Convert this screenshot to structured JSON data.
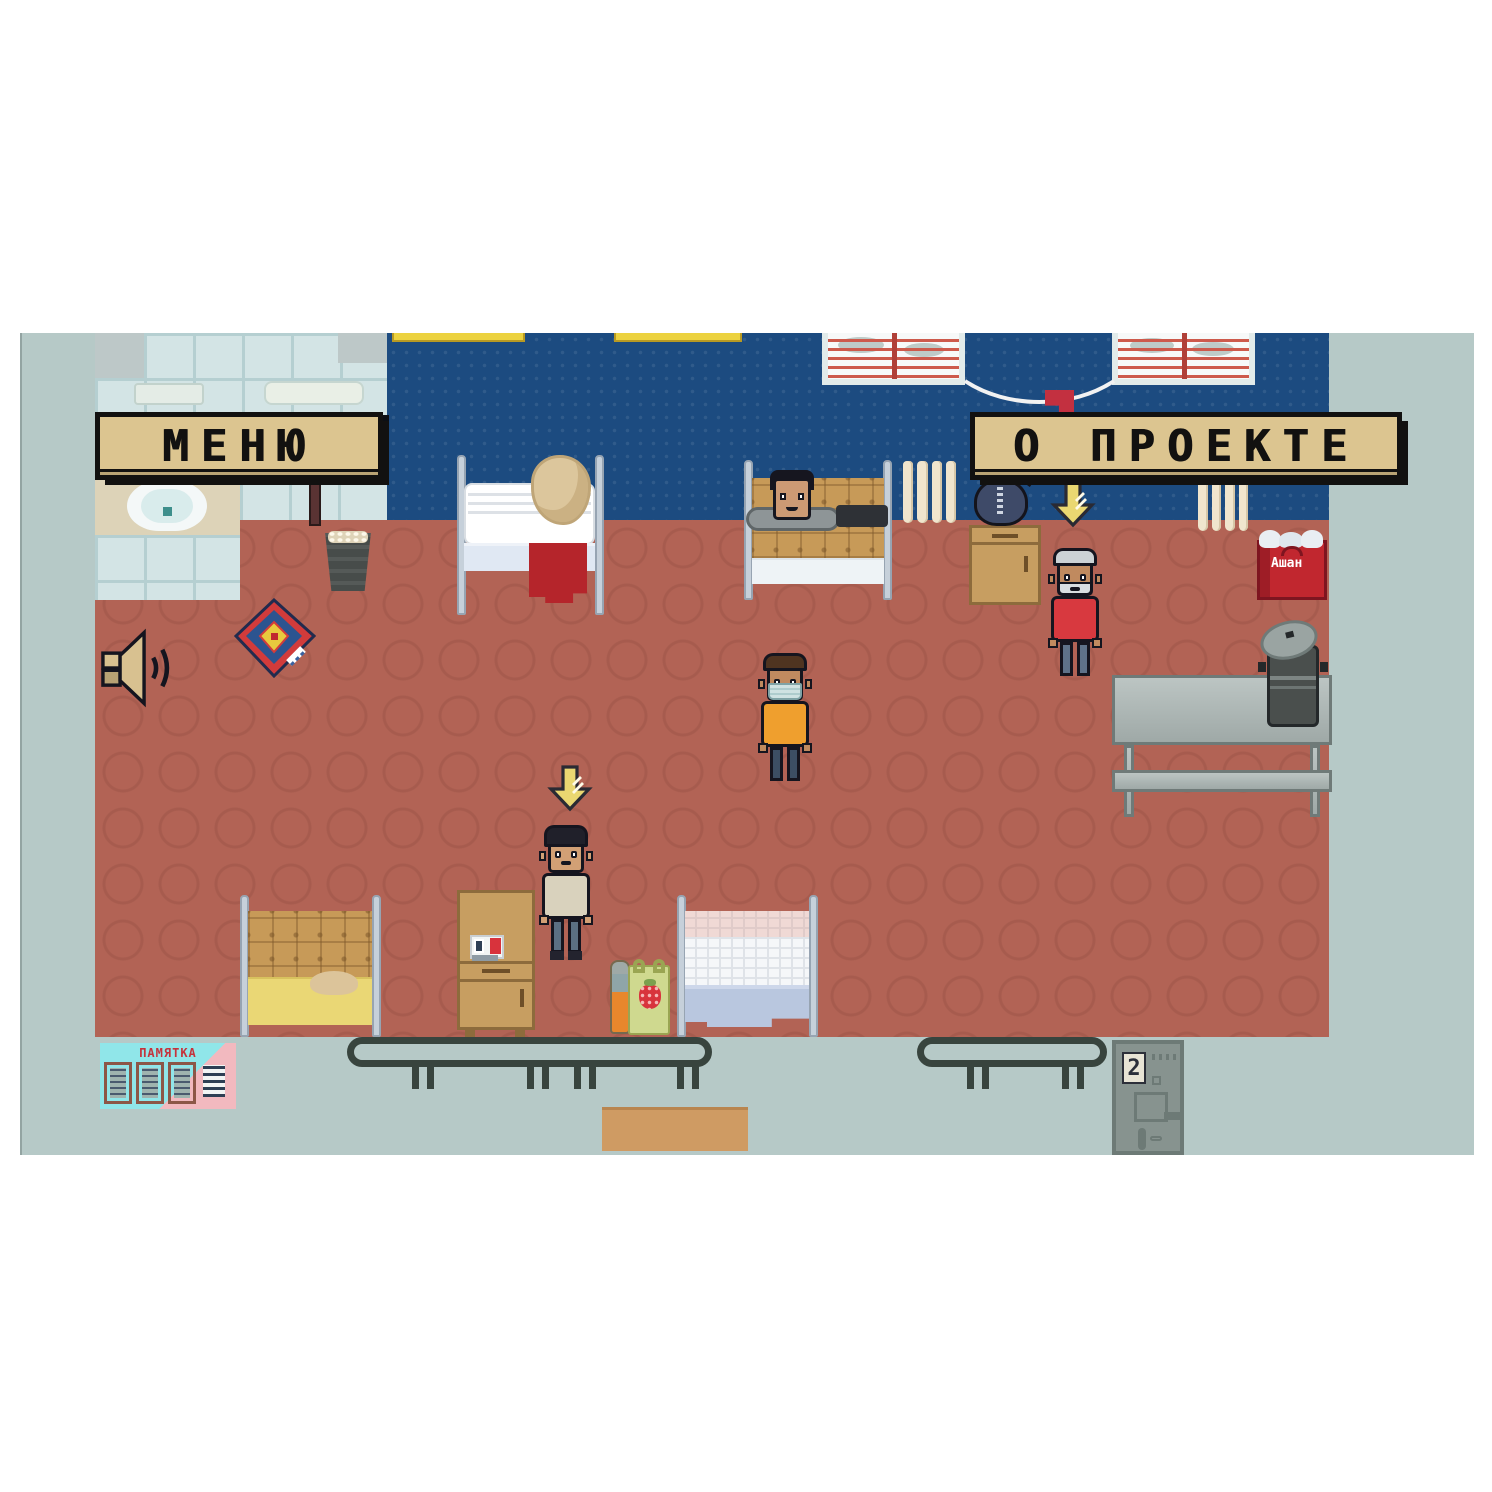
{
  "signs": {
    "menu_label": "МЕНЮ",
    "about_label": "О ПРОЕКТЕ"
  },
  "memo_poster": {
    "title": "ПАМЯТКА"
  },
  "door": {
    "number": "2"
  },
  "shopping_bag": {
    "brand_label": "Ашан"
  },
  "icons": {
    "sound": "speaker-icon",
    "interaction_marker": "down-arrow-icon"
  },
  "palette": {
    "wall_blue": "#1c4b80",
    "floor_terracotta": "#b26355",
    "outside_gray": "#b6c9c7",
    "sign_tan": "#dcc590",
    "sign_text": "#121110",
    "accent_red": "#c1272f",
    "arrow_yellow": "#ead771"
  },
  "characters": [
    {
      "id": "sleeping-man",
      "location": "top bed"
    },
    {
      "id": "old-man",
      "location": "by nightstand"
    },
    {
      "id": "masked-man",
      "location": "room center"
    },
    {
      "id": "player",
      "location": "lower center"
    }
  ]
}
